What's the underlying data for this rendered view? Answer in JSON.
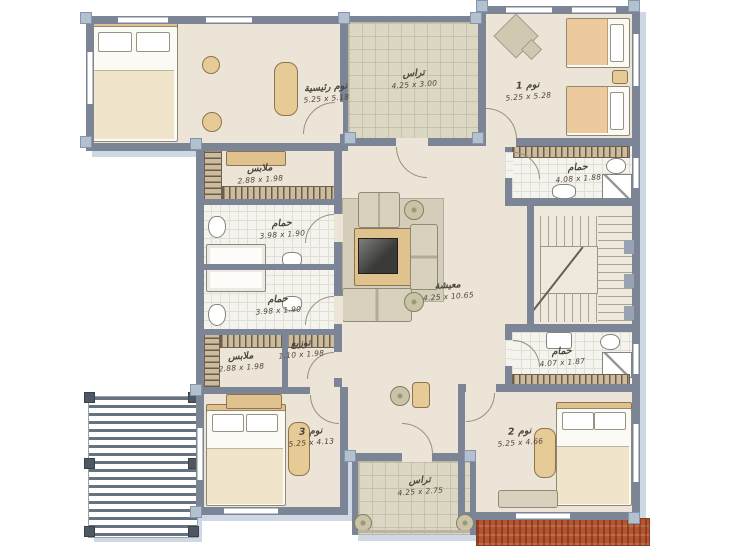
{
  "plan": {
    "title": "villa-floor-plan",
    "colors": {
      "wall": "#7b8596",
      "floor": "#ece4d6",
      "terrace": "#dbd7c3",
      "bath_tile": "#f5f3ee",
      "wood": "#e7cb97",
      "brick": "#b4552f",
      "shadow": "#cfd9e5",
      "label_text": "#4b463c"
    },
    "rooms": [
      {
        "id": "master-bedroom",
        "name": "نوم رئيسية",
        "dims": "5.25 x 5.18"
      },
      {
        "id": "terrace-top",
        "name": "تراس",
        "dims": "4.25 x 3.00"
      },
      {
        "id": "bedroom-1",
        "name": "نوم 1",
        "dims": "5.25 x 5.28"
      },
      {
        "id": "closet-upper",
        "name": "ملابس",
        "dims": "2.88 x 1.98"
      },
      {
        "id": "bathroom-upper",
        "name": "حمام",
        "dims": "3.98 x 1.90"
      },
      {
        "id": "bathroom-lower",
        "name": "حمام",
        "dims": "3.98 x 1.90"
      },
      {
        "id": "closet-lower",
        "name": "ملابس",
        "dims": "2.88 x 1.98"
      },
      {
        "id": "hall",
        "name": "توزيع",
        "dims": "1.10 x 1.98"
      },
      {
        "id": "living",
        "name": "معيشة",
        "dims": "4.25 x 10.65"
      },
      {
        "id": "bathroom-right-top",
        "name": "حمام",
        "dims": "4.08 x 1.88"
      },
      {
        "id": "bathroom-right-bottom",
        "name": "حمام",
        "dims": "4.07 x 1.87"
      },
      {
        "id": "bedroom-3",
        "name": "نوم 3",
        "dims": "5.25 x 4.13"
      },
      {
        "id": "bedroom-2",
        "name": "نوم 2",
        "dims": "5.25 x 4.66"
      },
      {
        "id": "terrace-bottom",
        "name": "تراس",
        "dims": "4.25 x 2.75"
      }
    ]
  }
}
